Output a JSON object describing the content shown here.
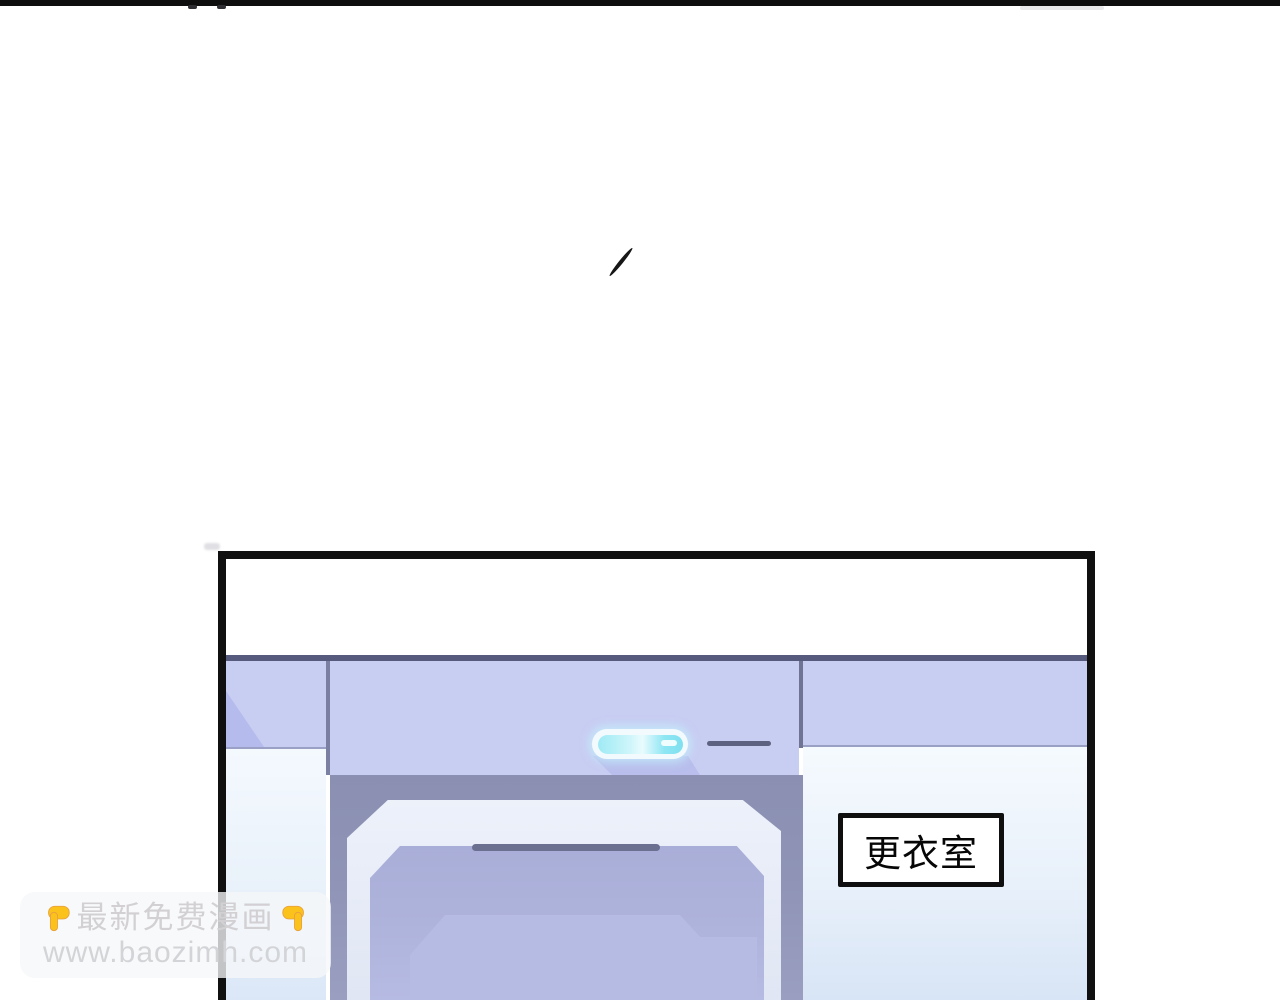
{
  "panel": {
    "sign_label": "更衣室"
  },
  "watermark": {
    "title": "最新免费漫画",
    "url": "www.baozimh.com",
    "left_icon": "point-down-icon",
    "right_icon": "point-down-icon"
  },
  "palette": {
    "top_bar": "#0e0e0e",
    "panel_border": "#101010",
    "wall_lavender": "#c8cdf2",
    "wall_divider_dark": "#565a7c",
    "alcove_shadow": "#8f94b6",
    "door_frame_light": "#e9eef9",
    "door_panel": "#aeb3db",
    "lamp_cyan": "#8ee6f3",
    "sign_text": "#060606",
    "watermark_text": "#d2d0d3",
    "hand_yellow": "#fcc21c"
  }
}
